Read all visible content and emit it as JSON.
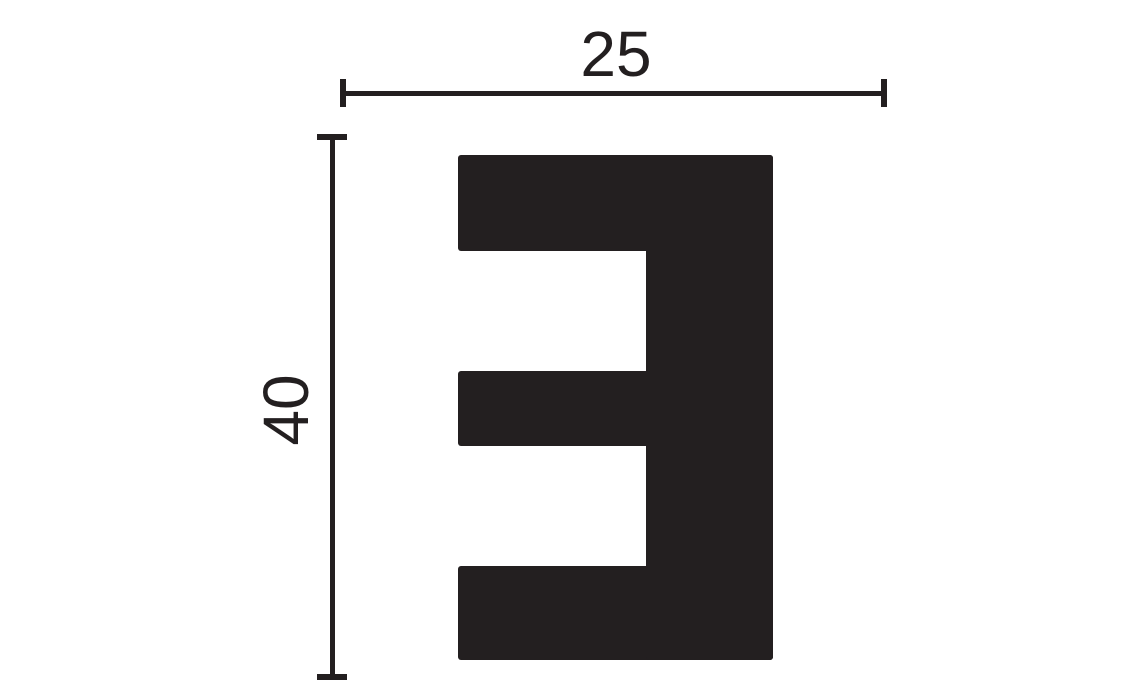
{
  "colors": {
    "ink": "#231f20",
    "background": "#ffffff"
  },
  "diagram": {
    "kind": "profile cross-section dimension drawing",
    "profile_shape": "mirrored-E",
    "dimensions": {
      "width": {
        "label": "25"
      },
      "height": {
        "label": "40"
      }
    }
  }
}
